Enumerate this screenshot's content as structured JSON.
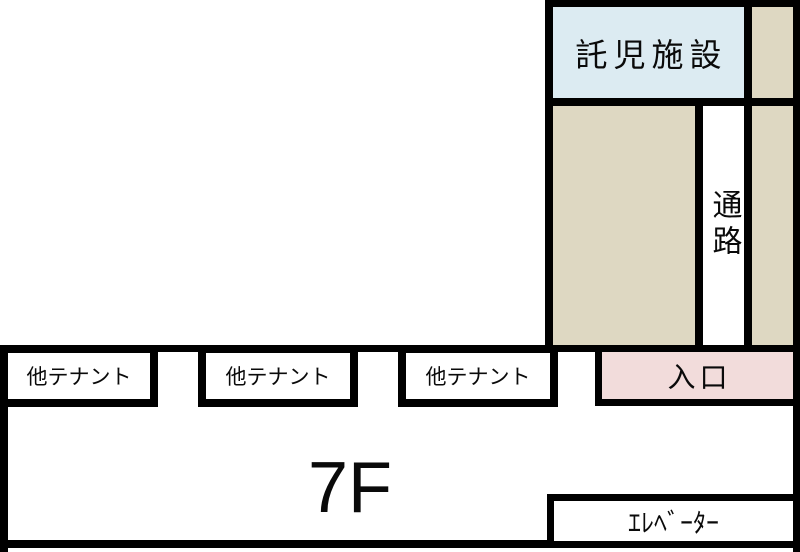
{
  "palette": {
    "wall": "#000000",
    "childcare_fill": "#dcebf2",
    "passage_block_fill": "#ded8c2",
    "entrance_fill": "#f2dcdb",
    "room_fill": "#ffffff",
    "text": "#0a0a0a"
  },
  "floor_plan": {
    "floor_label": "7F",
    "childcare_label": "託児施設",
    "corridor_label": "通路",
    "entrance_label": "入口",
    "elevator_label": "ｴﾚﾍﾞｰﾀｰ",
    "tenants": [
      {
        "label": "他テナント"
      },
      {
        "label": "他テナント"
      },
      {
        "label": "他テナント"
      }
    ]
  }
}
